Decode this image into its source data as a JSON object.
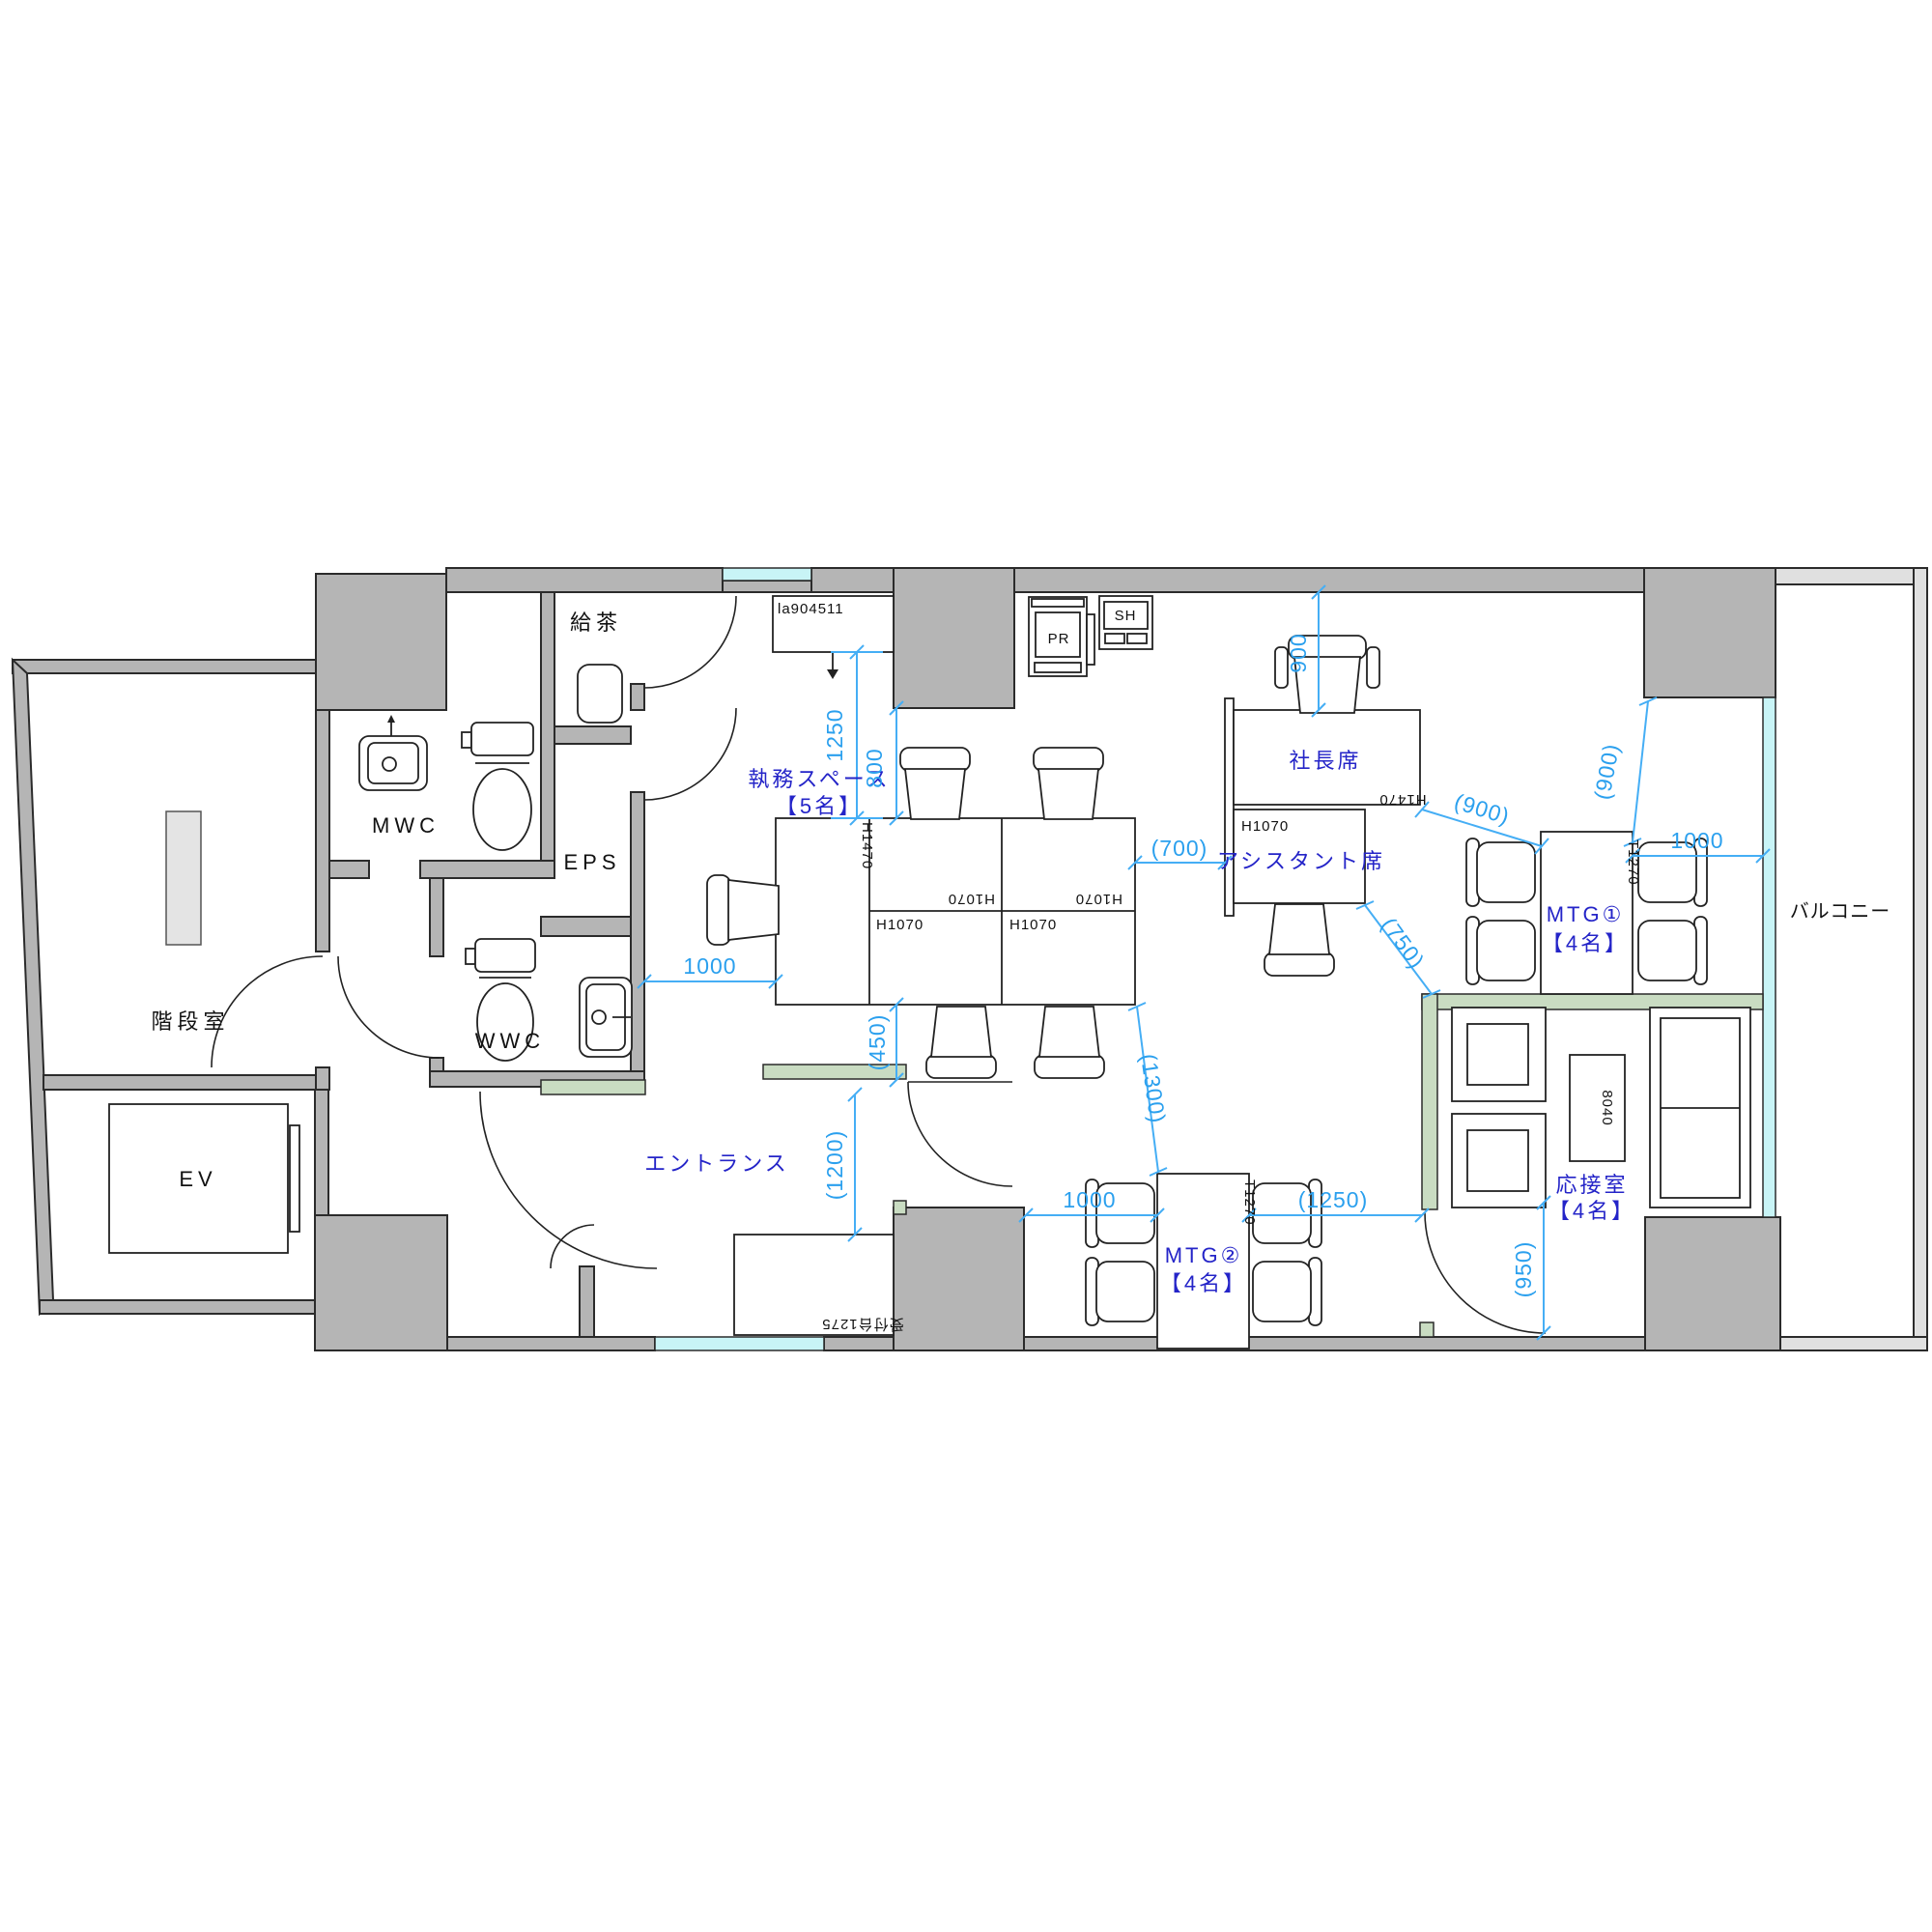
{
  "plan": {
    "rooms": {
      "stairwell": "階段室",
      "elevator": "EV",
      "mwc": "MWC",
      "wwc": "WWC",
      "eps": "EPS",
      "tea_room": "給茶",
      "entrance": "エントランス",
      "workspace_line1": "執務スペース",
      "workspace_line2": "【5名】",
      "president_seat": "社長席",
      "assistant_seat": "アシスタント席",
      "mtg1_line1": "MTG①",
      "mtg1_line2": "【4名】",
      "mtg2_line1": "MTG②",
      "mtg2_line2": "【4名】",
      "reception_line1": "応接室",
      "reception_line2": "【4名】",
      "balcony": "バルコニー"
    },
    "furniture": {
      "cabinet_code": "la904511",
      "printer": "PR",
      "shelf": "SH",
      "panel_h1470": "H1470",
      "panel_h1070": "H1070",
      "table_t1270": "T1270",
      "coffee_table_code": "8040",
      "reception_counter": "受付台1275"
    },
    "dimensions": {
      "d1250": "1250",
      "d800": "800",
      "d1000": "1000",
      "d450": "(450)",
      "d1200": "(1200)",
      "d900": "900",
      "d700": "(700)",
      "d750": "(750)",
      "d900p": "(900)",
      "d1300": "(1300)",
      "d1250p": "(1250)",
      "d950": "(950)"
    },
    "colors": {
      "wall_gray": "#b5b5b5",
      "balcony_wall_gray": "#e0e0e0",
      "window_cyan": "#c8f4f6",
      "partition_green": "#c9dcc2",
      "dimension_blue": "#45aef5",
      "room_label_blue": "#2424c8"
    }
  }
}
